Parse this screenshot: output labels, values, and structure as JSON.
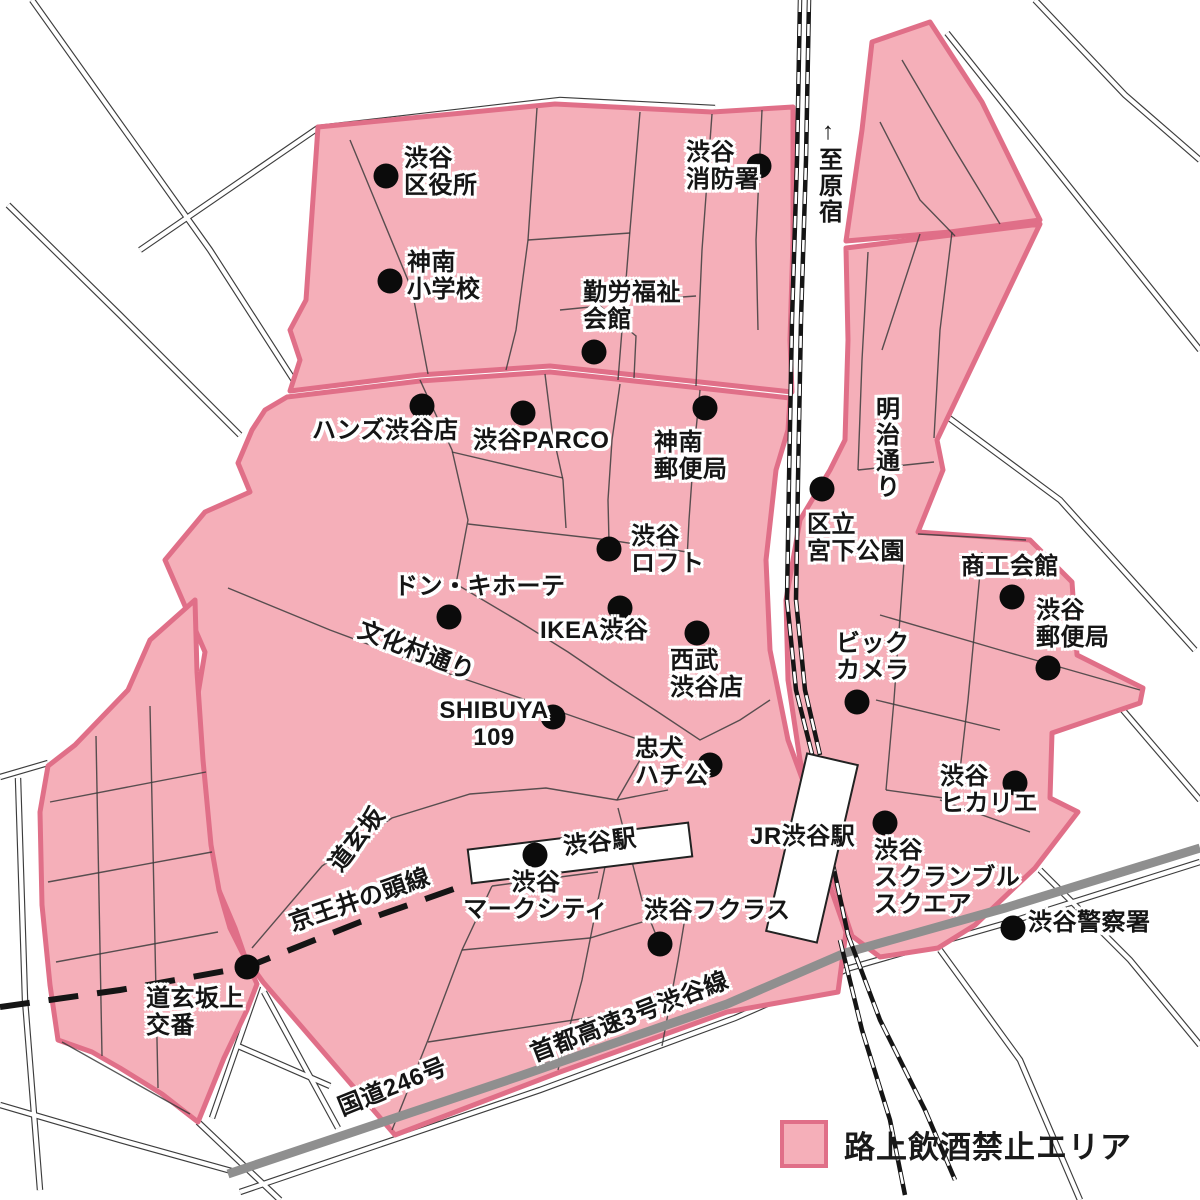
{
  "legend": {
    "label": "路上飲酒禁止エリア"
  },
  "colors": {
    "zone_fill": "#F5AFB9",
    "zone_border": "#E06F88",
    "road_line": "#3C3C3C",
    "expressway": "#8F8F8F",
    "railway": "#151515"
  },
  "stations": [
    {
      "name": "渋谷駅ビル",
      "cx": 580,
      "cy": 853,
      "w": 222,
      "h": 34,
      "angle": -7
    },
    {
      "name": "JR渋谷駅ビル",
      "cx": 812,
      "cy": 848,
      "w": 52,
      "h": 182,
      "angle": 13
    }
  ],
  "pois": [
    {
      "label": "渋谷\n区役所",
      "dot": [
        386,
        176
      ],
      "pos": [
        404,
        146
      ]
    },
    {
      "label": "神南\n小学校",
      "dot": [
        390,
        281
      ],
      "pos": [
        407,
        250
      ]
    },
    {
      "label": "渋谷\n消防署",
      "dot": [
        759,
        166
      ],
      "pos": [
        686,
        140
      ]
    },
    {
      "label": "勤労福祉\n会館",
      "dot": [
        594,
        352
      ],
      "pos": [
        583,
        280
      ]
    },
    {
      "label": "ハンズ渋谷店",
      "dot": [
        422,
        406
      ],
      "pos": [
        312,
        418
      ]
    },
    {
      "label": "渋谷PARCO",
      "dot": [
        523,
        413
      ],
      "pos": [
        473,
        428
      ]
    },
    {
      "label": "神南\n郵便局",
      "dot": [
        705,
        408
      ],
      "pos": [
        654,
        430
      ]
    },
    {
      "label": "区立\n宮下公園",
      "dot": [
        822,
        489
      ],
      "pos": [
        807,
        512
      ]
    },
    {
      "label": "渋谷\nロフト",
      "dot": [
        609,
        549
      ],
      "pos": [
        631,
        524
      ]
    },
    {
      "label": "ドン・キホーテ",
      "dot": [
        449,
        617
      ],
      "pos": [
        394,
        574
      ]
    },
    {
      "label": "IKEA渋谷",
      "dot": [
        620,
        608
      ],
      "pos": [
        540,
        618
      ]
    },
    {
      "label": "西武\n渋谷店",
      "dot": [
        697,
        633
      ],
      "pos": [
        670,
        648
      ]
    },
    {
      "label": "商工会館",
      "dot": [
        1012,
        597
      ],
      "pos": [
        961,
        554
      ]
    },
    {
      "label": "渋谷\n郵便局",
      "dot": [
        1048,
        668
      ],
      "pos": [
        1036,
        598
      ]
    },
    {
      "label": "ビック\nカメラ",
      "dot": [
        857,
        702
      ],
      "pos": [
        836,
        631
      ]
    },
    {
      "label": "SHIBUYA\n109",
      "dot": [
        553,
        717
      ],
      "pos": [
        494,
        698
      ],
      "anchor": "center"
    },
    {
      "label": "忠犬\nハチ公",
      "dot": [
        710,
        765
      ],
      "pos": [
        635,
        736
      ]
    },
    {
      "label": "渋谷\nヒカリエ",
      "dot": [
        1015,
        783
      ],
      "pos": [
        940,
        764
      ]
    },
    {
      "label": "渋谷駅",
      "dot": null,
      "pos": [
        600,
        830
      ],
      "anchor": "center",
      "rotate": -7
    },
    {
      "label": "JR渋谷駅",
      "dot": null,
      "pos": [
        750,
        824
      ]
    },
    {
      "label": "渋谷\nマークシティ",
      "dot": [
        535,
        855
      ],
      "pos": [
        536,
        870
      ],
      "anchor": "center"
    },
    {
      "label": "渋谷フクラス",
      "dot": [
        660,
        944
      ],
      "pos": [
        644,
        898
      ]
    },
    {
      "label": "渋谷\nスクランブル\nスクエア",
      "dot": [
        885,
        823
      ],
      "pos": [
        874,
        838
      ]
    },
    {
      "label": "渋谷警察署",
      "dot": [
        1013,
        928
      ],
      "pos": [
        1028,
        910
      ]
    },
    {
      "label": "道玄坂上\n交番",
      "dot": [
        247,
        967
      ],
      "pos": [
        146,
        986
      ]
    }
  ],
  "street_labels": [
    {
      "label": "↑至原宿",
      "x": 827,
      "y": 118,
      "mode": "vertical"
    },
    {
      "label": "明治通り",
      "x": 884,
      "y": 396,
      "mode": "vertical"
    },
    {
      "label": "文化村通り",
      "x": 416,
      "y": 652,
      "rotate": 21
    },
    {
      "label": "道玄坂",
      "x": 358,
      "y": 840,
      "rotate": -52
    },
    {
      "label": "京王井の頭線",
      "x": 360,
      "y": 901,
      "rotate": -19
    },
    {
      "label": "首都高速3号渋谷線",
      "x": 630,
      "y": 1018,
      "rotate": -21
    },
    {
      "label": "国道246号",
      "x": 393,
      "y": 1088,
      "rotate": -22
    }
  ]
}
